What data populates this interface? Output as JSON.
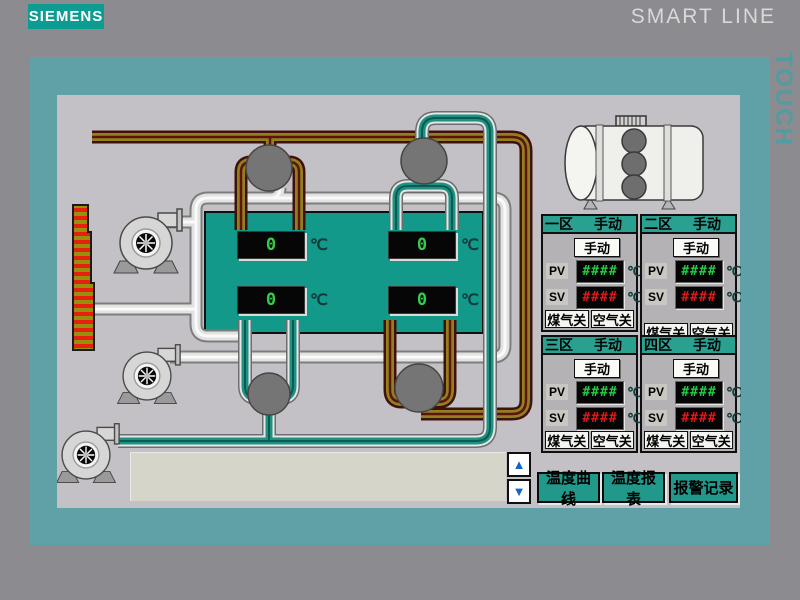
{
  "brand": {
    "logo": "SIEMENS",
    "product": "SMART LINE",
    "model": "TOUCH"
  },
  "furnace": {
    "displays": [
      {
        "value": "0",
        "unit": "℃"
      },
      {
        "value": "0",
        "unit": "℃"
      },
      {
        "value": "0",
        "unit": "℃"
      },
      {
        "value": "0",
        "unit": "℃"
      }
    ]
  },
  "zones": [
    {
      "name": "一区",
      "mode_status": "手动",
      "manual_button": "手动",
      "pv_label": "PV",
      "pv_value": "####",
      "sv_label": "SV",
      "sv_value": "####",
      "unit": "℃",
      "gas_button": "煤气关",
      "air_button": "空气关"
    },
    {
      "name": "二区",
      "mode_status": "手动",
      "manual_button": "手动",
      "pv_label": "PV",
      "pv_value": "####",
      "sv_label": "SV",
      "sv_value": "####",
      "unit": "℃",
      "gas_button": "煤气关",
      "air_button": "空气关"
    },
    {
      "name": "三区",
      "mode_status": "手动",
      "manual_button": "手动",
      "pv_label": "PV",
      "pv_value": "####",
      "sv_label": "SV",
      "sv_value": "####",
      "unit": "℃",
      "gas_button": "煤气关",
      "air_button": "空气关"
    },
    {
      "name": "四区",
      "mode_status": "手动",
      "manual_button": "手动",
      "pv_label": "PV",
      "pv_value": "####",
      "sv_label": "SV",
      "sv_value": "####",
      "unit": "℃",
      "gas_button": "煤气关",
      "air_button": "空气关"
    }
  ],
  "pager": {
    "up": "▲",
    "down": "▼"
  },
  "footer": {
    "buttons": [
      {
        "label": "温度曲线"
      },
      {
        "label": "温度报表"
      },
      {
        "label": "报警记录"
      }
    ]
  },
  "colors": {
    "bezel_teal": "#5fa1a6",
    "siemens_teal": "#0c9c92",
    "furnace_teal": "#12998a",
    "zone_header_teal": "#2aa091",
    "pv_green": "#22cc44",
    "sv_red": "#e01818",
    "gas_pipe_olive": "#92801e",
    "air_pipe_teal": "#1f9182"
  }
}
